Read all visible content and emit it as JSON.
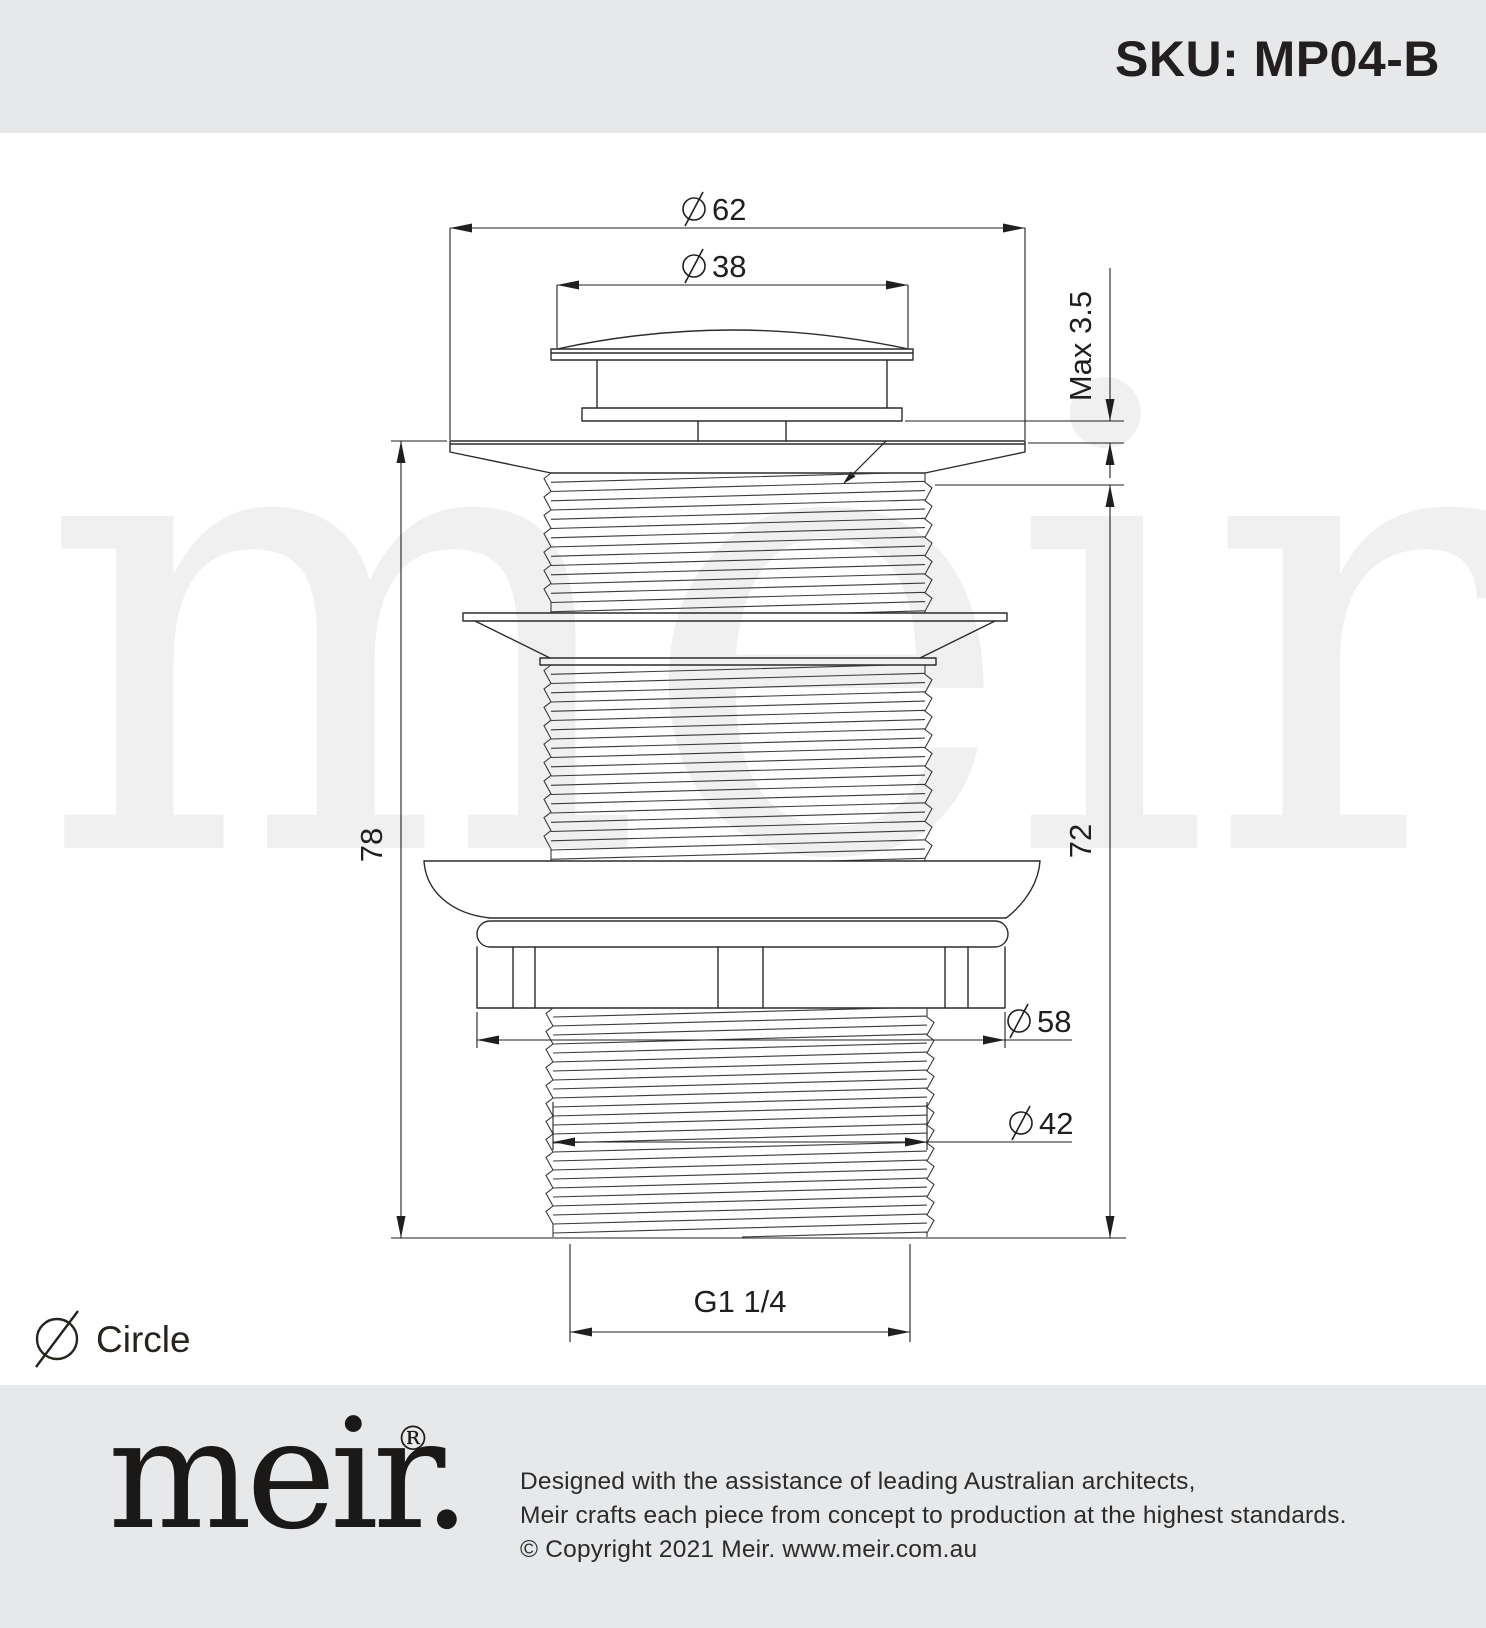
{
  "header": {
    "sku": "SKU: MP04-B"
  },
  "watermark": {
    "text": "meir."
  },
  "drawing": {
    "dim_top_flange_diameter": "62",
    "dim_cap_diameter": "38",
    "dim_protrusion": "Max 3.5",
    "dim_overall_height": "78",
    "dim_body_height": "72",
    "dim_nut_diameter": "58",
    "dim_thread_diameter": "42",
    "dim_thread_spec": "G1 1/4"
  },
  "legend": {
    "label": "Circle"
  },
  "footer": {
    "logo_text": "meir.",
    "registered_mark": "®",
    "lines": [
      "Designed with the assistance of leading Australian architects,",
      "Meir crafts each piece from concept to production at the highest standards.",
      "© Copyright 2021 Meir. www.meir.com.au"
    ]
  },
  "colors": {
    "band_background": "#e7e8ea",
    "line": "#231f20",
    "watermark": "#f0f0f1",
    "text": "#231f20"
  }
}
